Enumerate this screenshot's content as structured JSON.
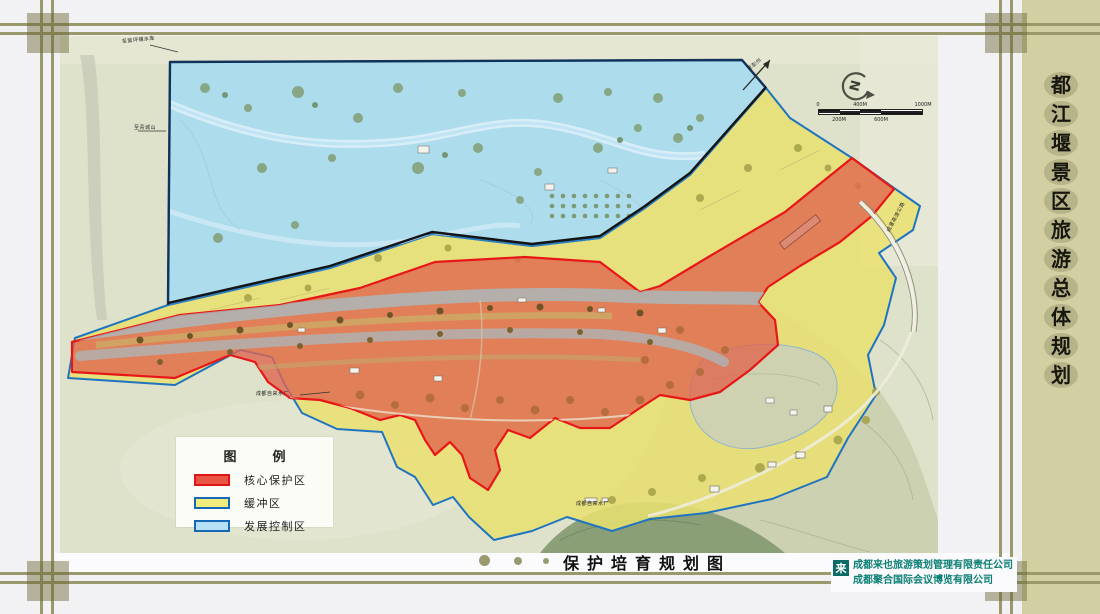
{
  "page": {
    "background": "#f2f2f5",
    "frame_line_color": "#9a996b",
    "paper_color": "#dfe2ca"
  },
  "sidebar": {
    "background": "#d2cfa3",
    "title": "都江堰景区旅游总体规划",
    "title_chars": [
      "都",
      "江",
      "堰",
      "景",
      "区",
      "旅",
      "游",
      "总",
      "体",
      "规",
      "划"
    ]
  },
  "map": {
    "legend": {
      "title": "图例",
      "items": [
        {
          "label": "核心保护区",
          "fill": "#ea5545",
          "stroke": "#dd1515"
        },
        {
          "label": "缓冲区",
          "fill": "#f2ec7d",
          "stroke": "#1568b6"
        },
        {
          "label": "发展控制区",
          "fill": "#b5e0f6",
          "stroke": "#1568b6"
        }
      ]
    },
    "compass": {
      "letter": "N"
    },
    "scalebar": {
      "top_labels": [
        {
          "t": "0",
          "o": 0
        },
        {
          "t": "400M",
          "o": 42
        },
        {
          "t": "1000M",
          "o": 105
        }
      ],
      "bottom_labels": [
        {
          "t": "200M",
          "o": 21
        },
        {
          "t": "600M",
          "o": 63
        }
      ]
    },
    "labels": [
      {
        "text": "至紫坪铺水库",
        "x": 122,
        "y": 38,
        "rot": -6
      },
      {
        "text": "至青城山",
        "x": 134,
        "y": 124,
        "rot": 0
      },
      {
        "text": "成都自来水厂",
        "x": 256,
        "y": 390,
        "rot": 0
      },
      {
        "text": "成都自来水厂",
        "x": 576,
        "y": 500,
        "rot": 0
      },
      {
        "text": "至彭州",
        "x": 748,
        "y": 66,
        "rot": -38
      },
      {
        "text": "成灌高速公路",
        "x": 888,
        "y": 228,
        "rot": -62
      }
    ],
    "zone_colors": {
      "core": "#e06750",
      "buffer": "#e9e170",
      "development": "#a8dbf0"
    }
  },
  "footer": {
    "title": "保护培育规划图",
    "credits": [
      "成都来也旅游策划管理有限责任公司",
      "成都聚合国际会议博览有限公司"
    ],
    "logo_glyph": "来",
    "credit_color": "#0c7f74"
  }
}
